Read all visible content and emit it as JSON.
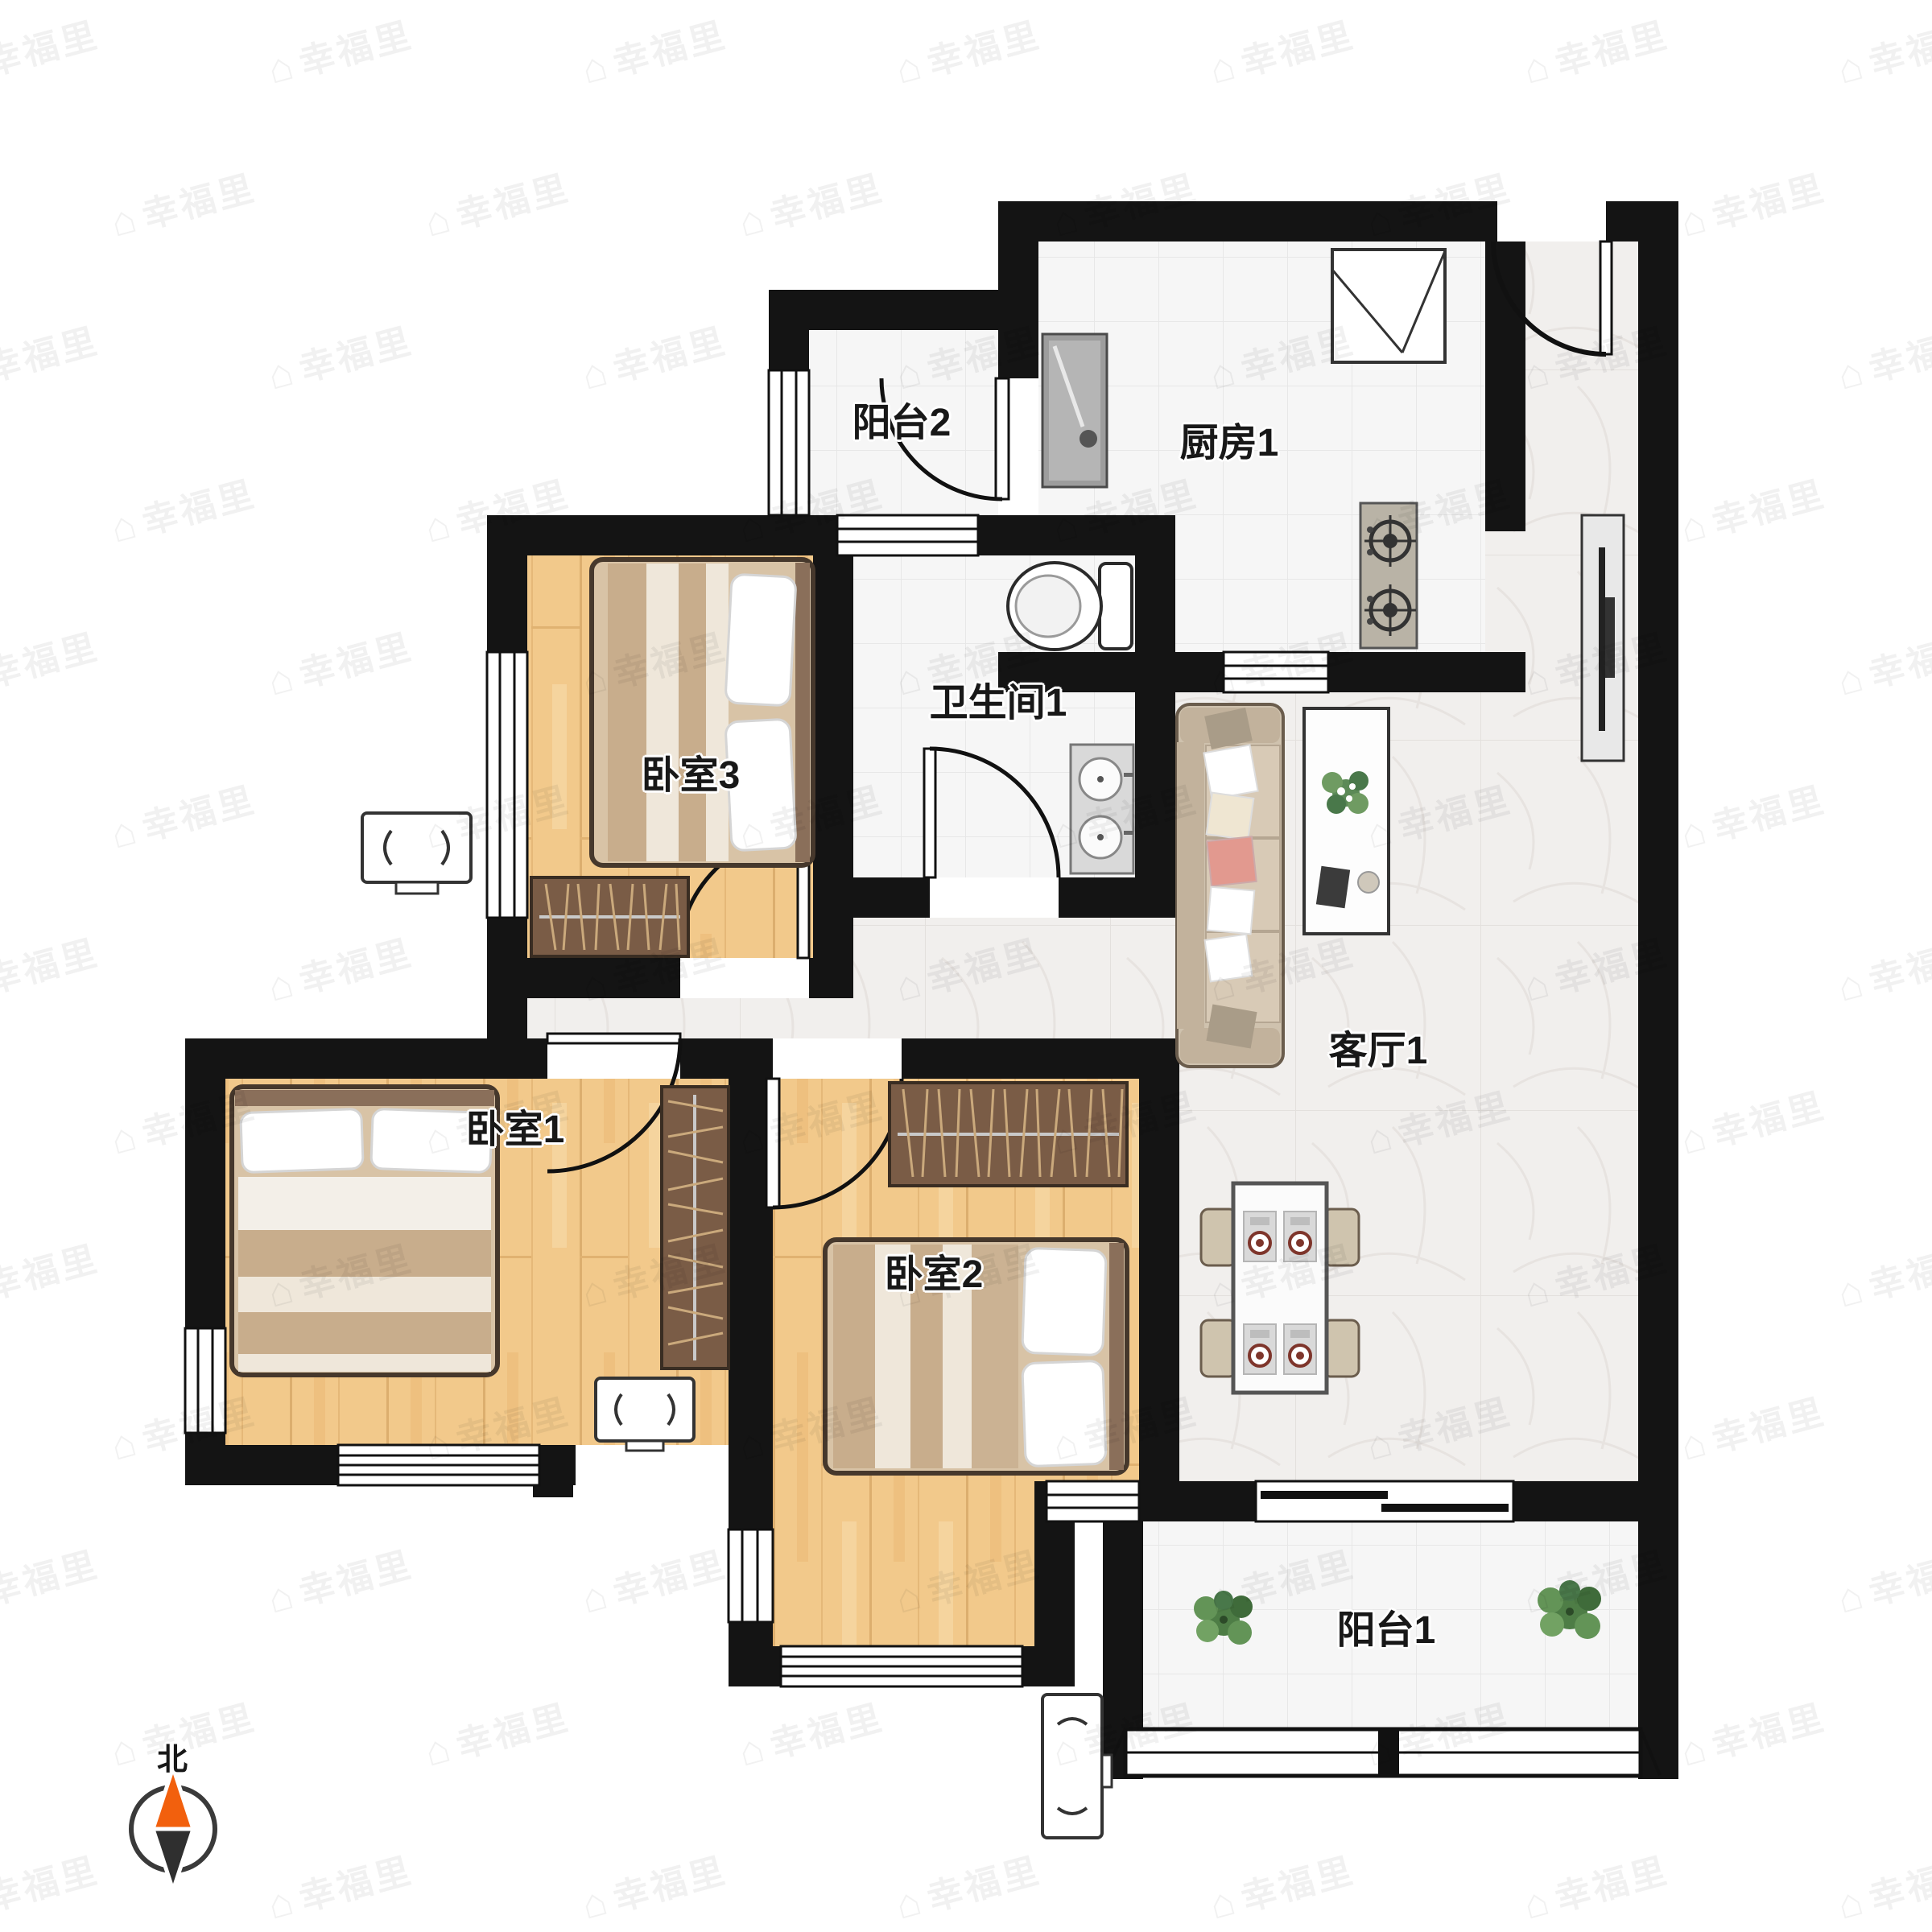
{
  "floorplan": {
    "watermark_text": "幸福里",
    "compass": {
      "label": "北"
    },
    "rooms": [
      {
        "id": "balcony-2",
        "label": "阳台2"
      },
      {
        "id": "kitchen-1",
        "label": "厨房1"
      },
      {
        "id": "bathroom-1",
        "label": "卫生间1"
      },
      {
        "id": "bedroom-3",
        "label": "卧室3"
      },
      {
        "id": "bedroom-1",
        "label": "卧室1"
      },
      {
        "id": "bedroom-2",
        "label": "卧室2"
      },
      {
        "id": "living-room-1",
        "label": "客厅1"
      },
      {
        "id": "balcony-1",
        "label": "阳台1"
      }
    ],
    "colors": {
      "wall": "#141414",
      "wood_floor": "#f2c98b",
      "tile_floor": "#f6f6f6",
      "marble_floor": "#f1efed",
      "north_needle": "#f2600d"
    }
  }
}
